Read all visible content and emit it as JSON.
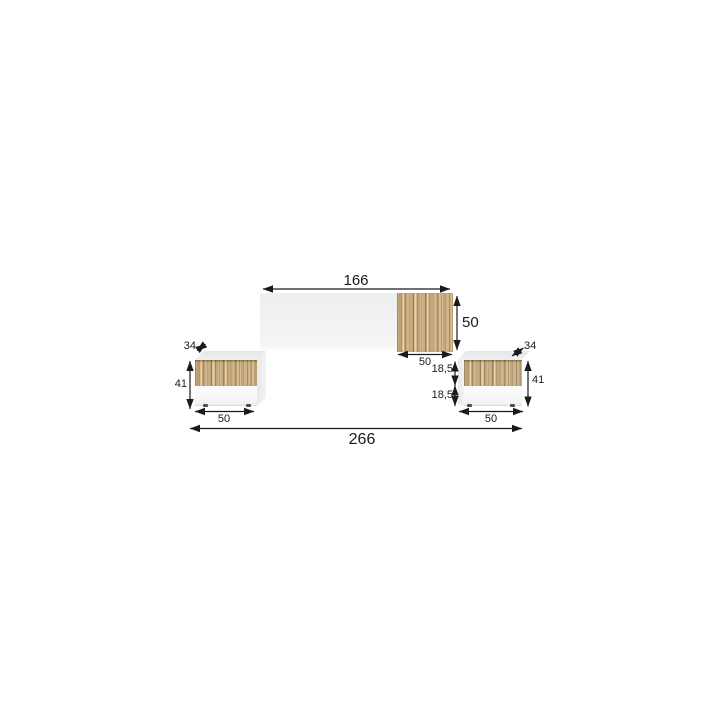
{
  "page": {
    "background": "#ffffff",
    "description": "Dimension diagram of a wall headboard with two floating nightstands"
  },
  "diagram": {
    "type": "furniture-dimension-diagram",
    "units": "cm",
    "colors": {
      "wood": "#c8ac82",
      "panel_white": "#f1f2f1",
      "face_gray": "#e9eaea",
      "dimension_lines": "#1a1a1a"
    },
    "dimensions": {
      "headboard_width": "166",
      "headboard_height": "50",
      "headboard_wood_panel_width": "50",
      "left_nightstand_depth": "34",
      "left_nightstand_height": "41",
      "left_nightstand_width": "50",
      "right_nightstand_depth": "34",
      "right_nightstand_height": "41",
      "right_nightstand_width": "50",
      "right_drawer_front_top_height": "18,5",
      "right_drawer_front_bottom_height": "18,5",
      "total_width": "266"
    }
  }
}
